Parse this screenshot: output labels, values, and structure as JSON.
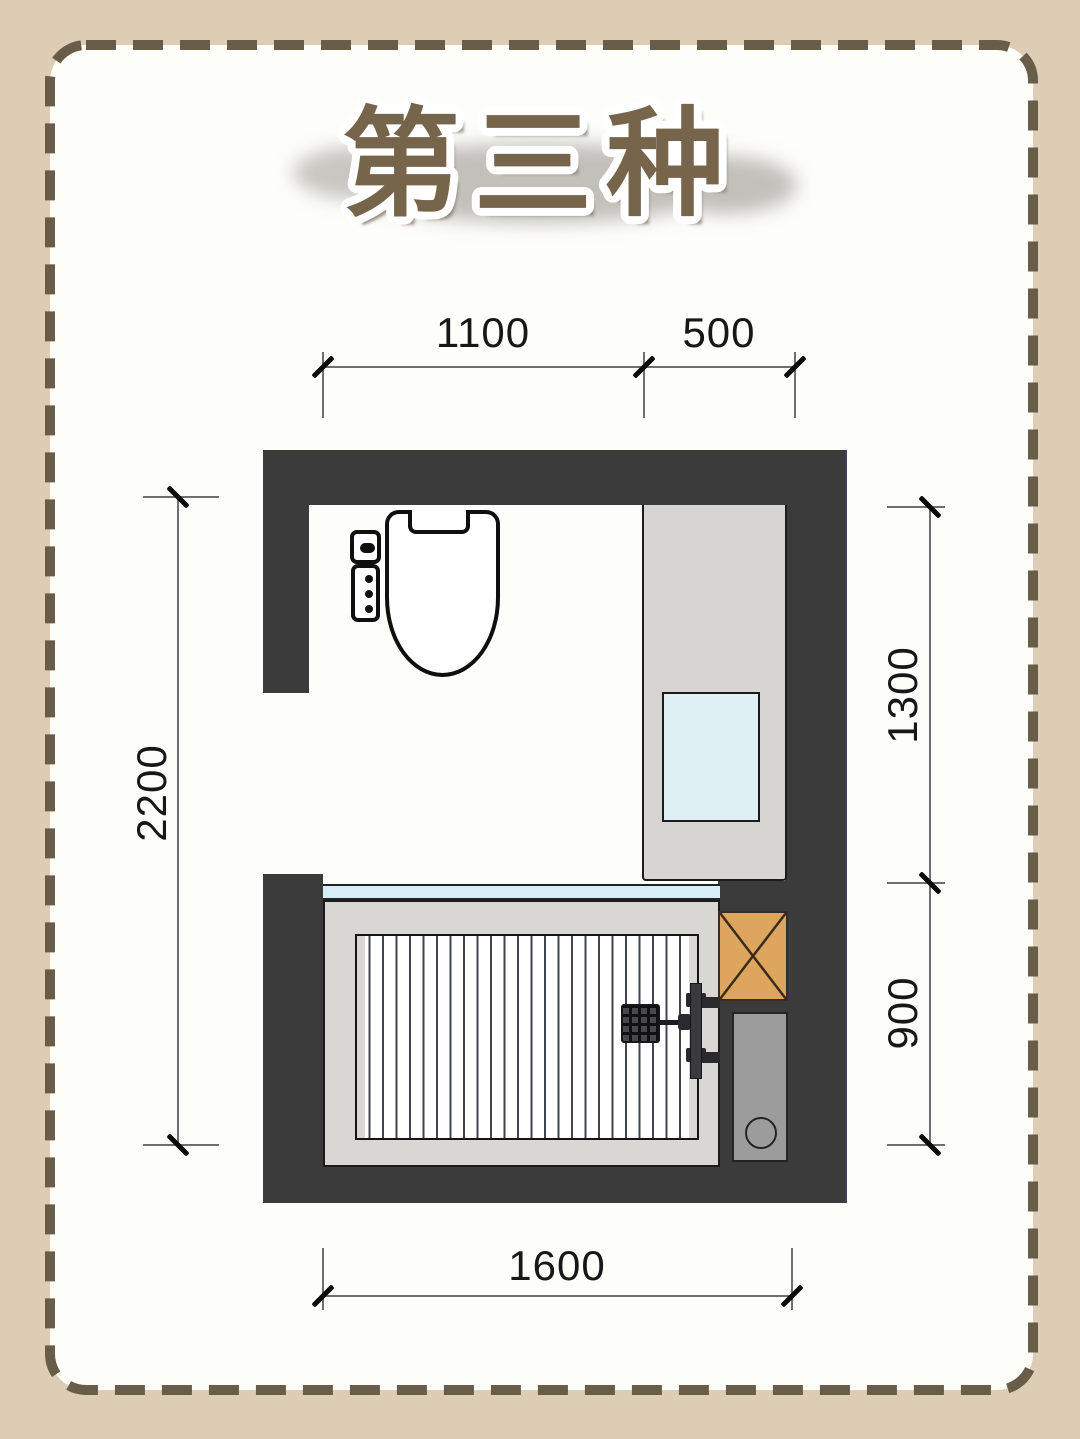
{
  "title": {
    "text": "第三种"
  },
  "dimensions": {
    "top_left": "1100",
    "top_right": "500",
    "left": "2200",
    "right_upper": "1300",
    "right_lower": "900",
    "bottom": "1600"
  },
  "icons": {
    "toilet": "smart-toilet-top-view-icon",
    "toilet_panel": "toilet-control-panel-icon",
    "vanity": "vanity-counter-icon",
    "sink": "wash-basin-icon",
    "glass": "glass-partition-icon",
    "bathtub": "bathtub-top-view-icon",
    "shower": "shower-fixture-icon",
    "shaft": "pipe-shaft-cross-icon",
    "drain": "floor-drain-unit-icon"
  },
  "colors": {
    "background": "#dccdb4",
    "card": "#fdfdf9",
    "dash_border": "#695c48",
    "wall": "#3b3b3b",
    "counter": "#d6d5d1",
    "sink_blue": "#def0f4",
    "glass_blue": "#d8eef6",
    "tub_surround": "#d8d7d3",
    "tub_stripe": "#41434e",
    "shaft_orange": "#dda55e",
    "drain_gray": "#9c9c9c",
    "title_brown": "#76644b",
    "dim_text": "#17171a"
  }
}
